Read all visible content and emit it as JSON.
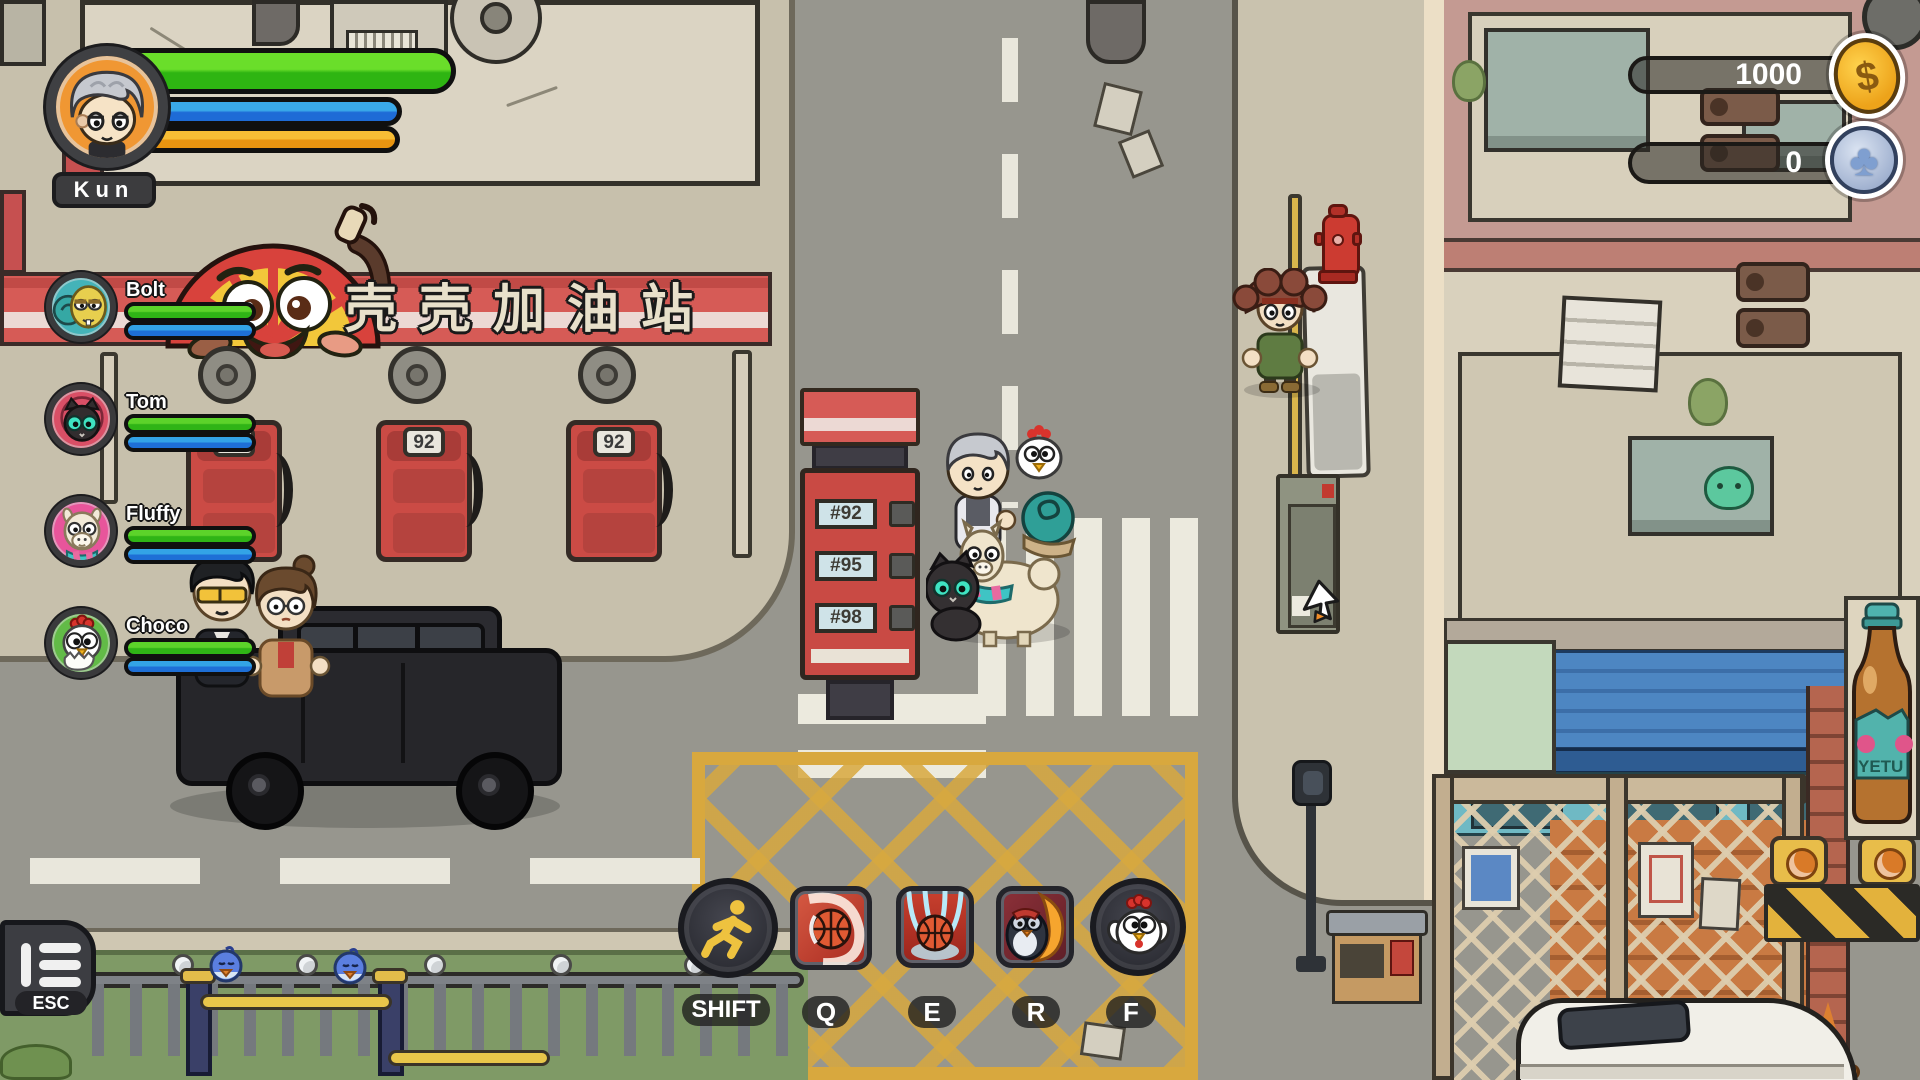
{
  "hud": {
    "player": {
      "name": "Kun"
    },
    "party": [
      {
        "name": "Bolt"
      },
      {
        "name": "Tom"
      },
      {
        "name": "Fluffy"
      },
      {
        "name": "Choco"
      }
    ],
    "currency": {
      "coins": "1000",
      "tokens": "0"
    },
    "skills": [
      {
        "key": "SHIFT",
        "icon": "sprint-icon"
      },
      {
        "key": "Q",
        "icon": "basketball-shot-icon"
      },
      {
        "key": "E",
        "icon": "basketball-slam-icon"
      },
      {
        "key": "R",
        "icon": "penguin-flame-icon"
      },
      {
        "key": "F",
        "icon": "chicken-icon"
      }
    ],
    "menu": {
      "label": "ESC",
      "icon": "menu-icon"
    }
  },
  "scene": {
    "gas_station_sign": "壳壳加油站",
    "pump_label": "92",
    "fuel_price_tags": [
      "#92",
      "#95",
      "#98"
    ],
    "bottle_brand": "YETU"
  },
  "icons": {
    "dollar": "$",
    "club": "♣"
  },
  "colors": {
    "hp_green": "#3fc01a",
    "mana_blue": "#2a8ee0",
    "stamina_orange": "#f0a524",
    "coin_gold": "#f4b326",
    "token_silver_blue": "#9fb4d8",
    "awning_red": "#d65b56",
    "hatch_yellow": "#d8a83e"
  }
}
